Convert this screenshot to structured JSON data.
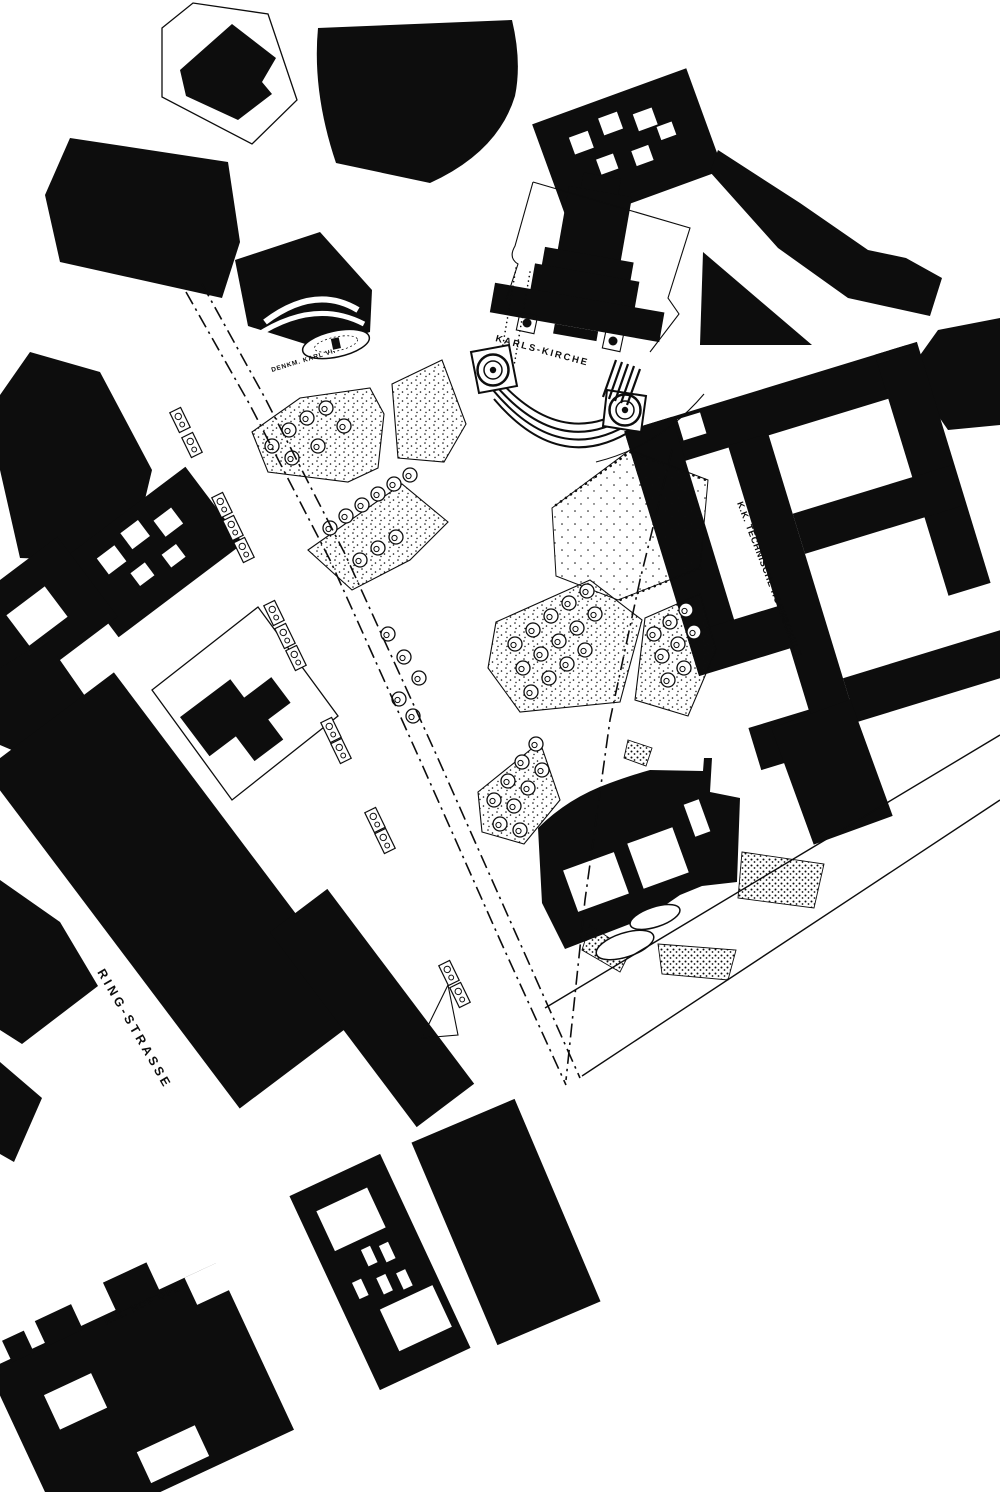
{
  "map": {
    "region": "Karlsplatz and Ringstrasse district figure-ground plan",
    "style": "black ink buildings on white paper, parks stippled with trees",
    "ink_color": "#0d0d0d",
    "paper_color": "#ffffff",
    "labels": {
      "karls_kirche": "KARLS-KIRCHE",
      "denkmal_karl_vi": "DENKM. KARL VI.",
      "ring_strasse": "RING-STRASSE",
      "kk_hof_oper": "K.K. HOF OPER",
      "kk_technische_hochschule": "K.K. TECHNISCHE HOCHSCHULE."
    }
  }
}
